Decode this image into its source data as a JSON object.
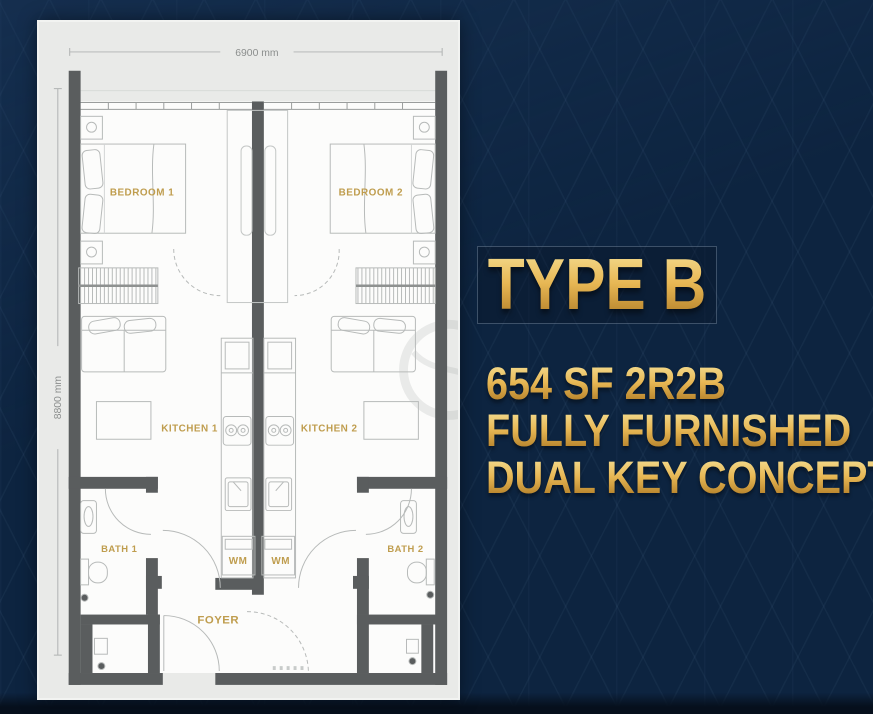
{
  "info_panel": {
    "type_label": "TYPE B",
    "specs": [
      "654 SF 2R2B",
      "FULLY FURNISHED",
      "DUAL KEY CONCEPT"
    ],
    "gold_light": "#f7e49c",
    "gold_mid": "#e7b754",
    "gold_dark": "#a8762a"
  },
  "floor_plan": {
    "dim_width": "6900 mm",
    "dim_height": "8800 mm",
    "labels": {
      "bedroom1": "BEDROOM 1",
      "bedroom2": "BEDROOM 2",
      "kitchen1": "KITCHEN 1",
      "kitchen2": "KITCHEN 2",
      "bath1": "BATH 1",
      "bath2": "BATH 2",
      "wm1": "WM",
      "wm2": "WM",
      "foyer": "FOYER"
    },
    "colors": {
      "wall": "#5a5d5e",
      "furniture_line": "#b7bab9",
      "room_label_gold": "#bf9d4e",
      "panel_bg": "#e9eae8",
      "floor": "#fcfcfb",
      "dimension_text": "#8b8e8d"
    }
  },
  "background": {
    "base": "#0d2440",
    "pattern_line": "rgba(130,165,205,0.06)"
  }
}
